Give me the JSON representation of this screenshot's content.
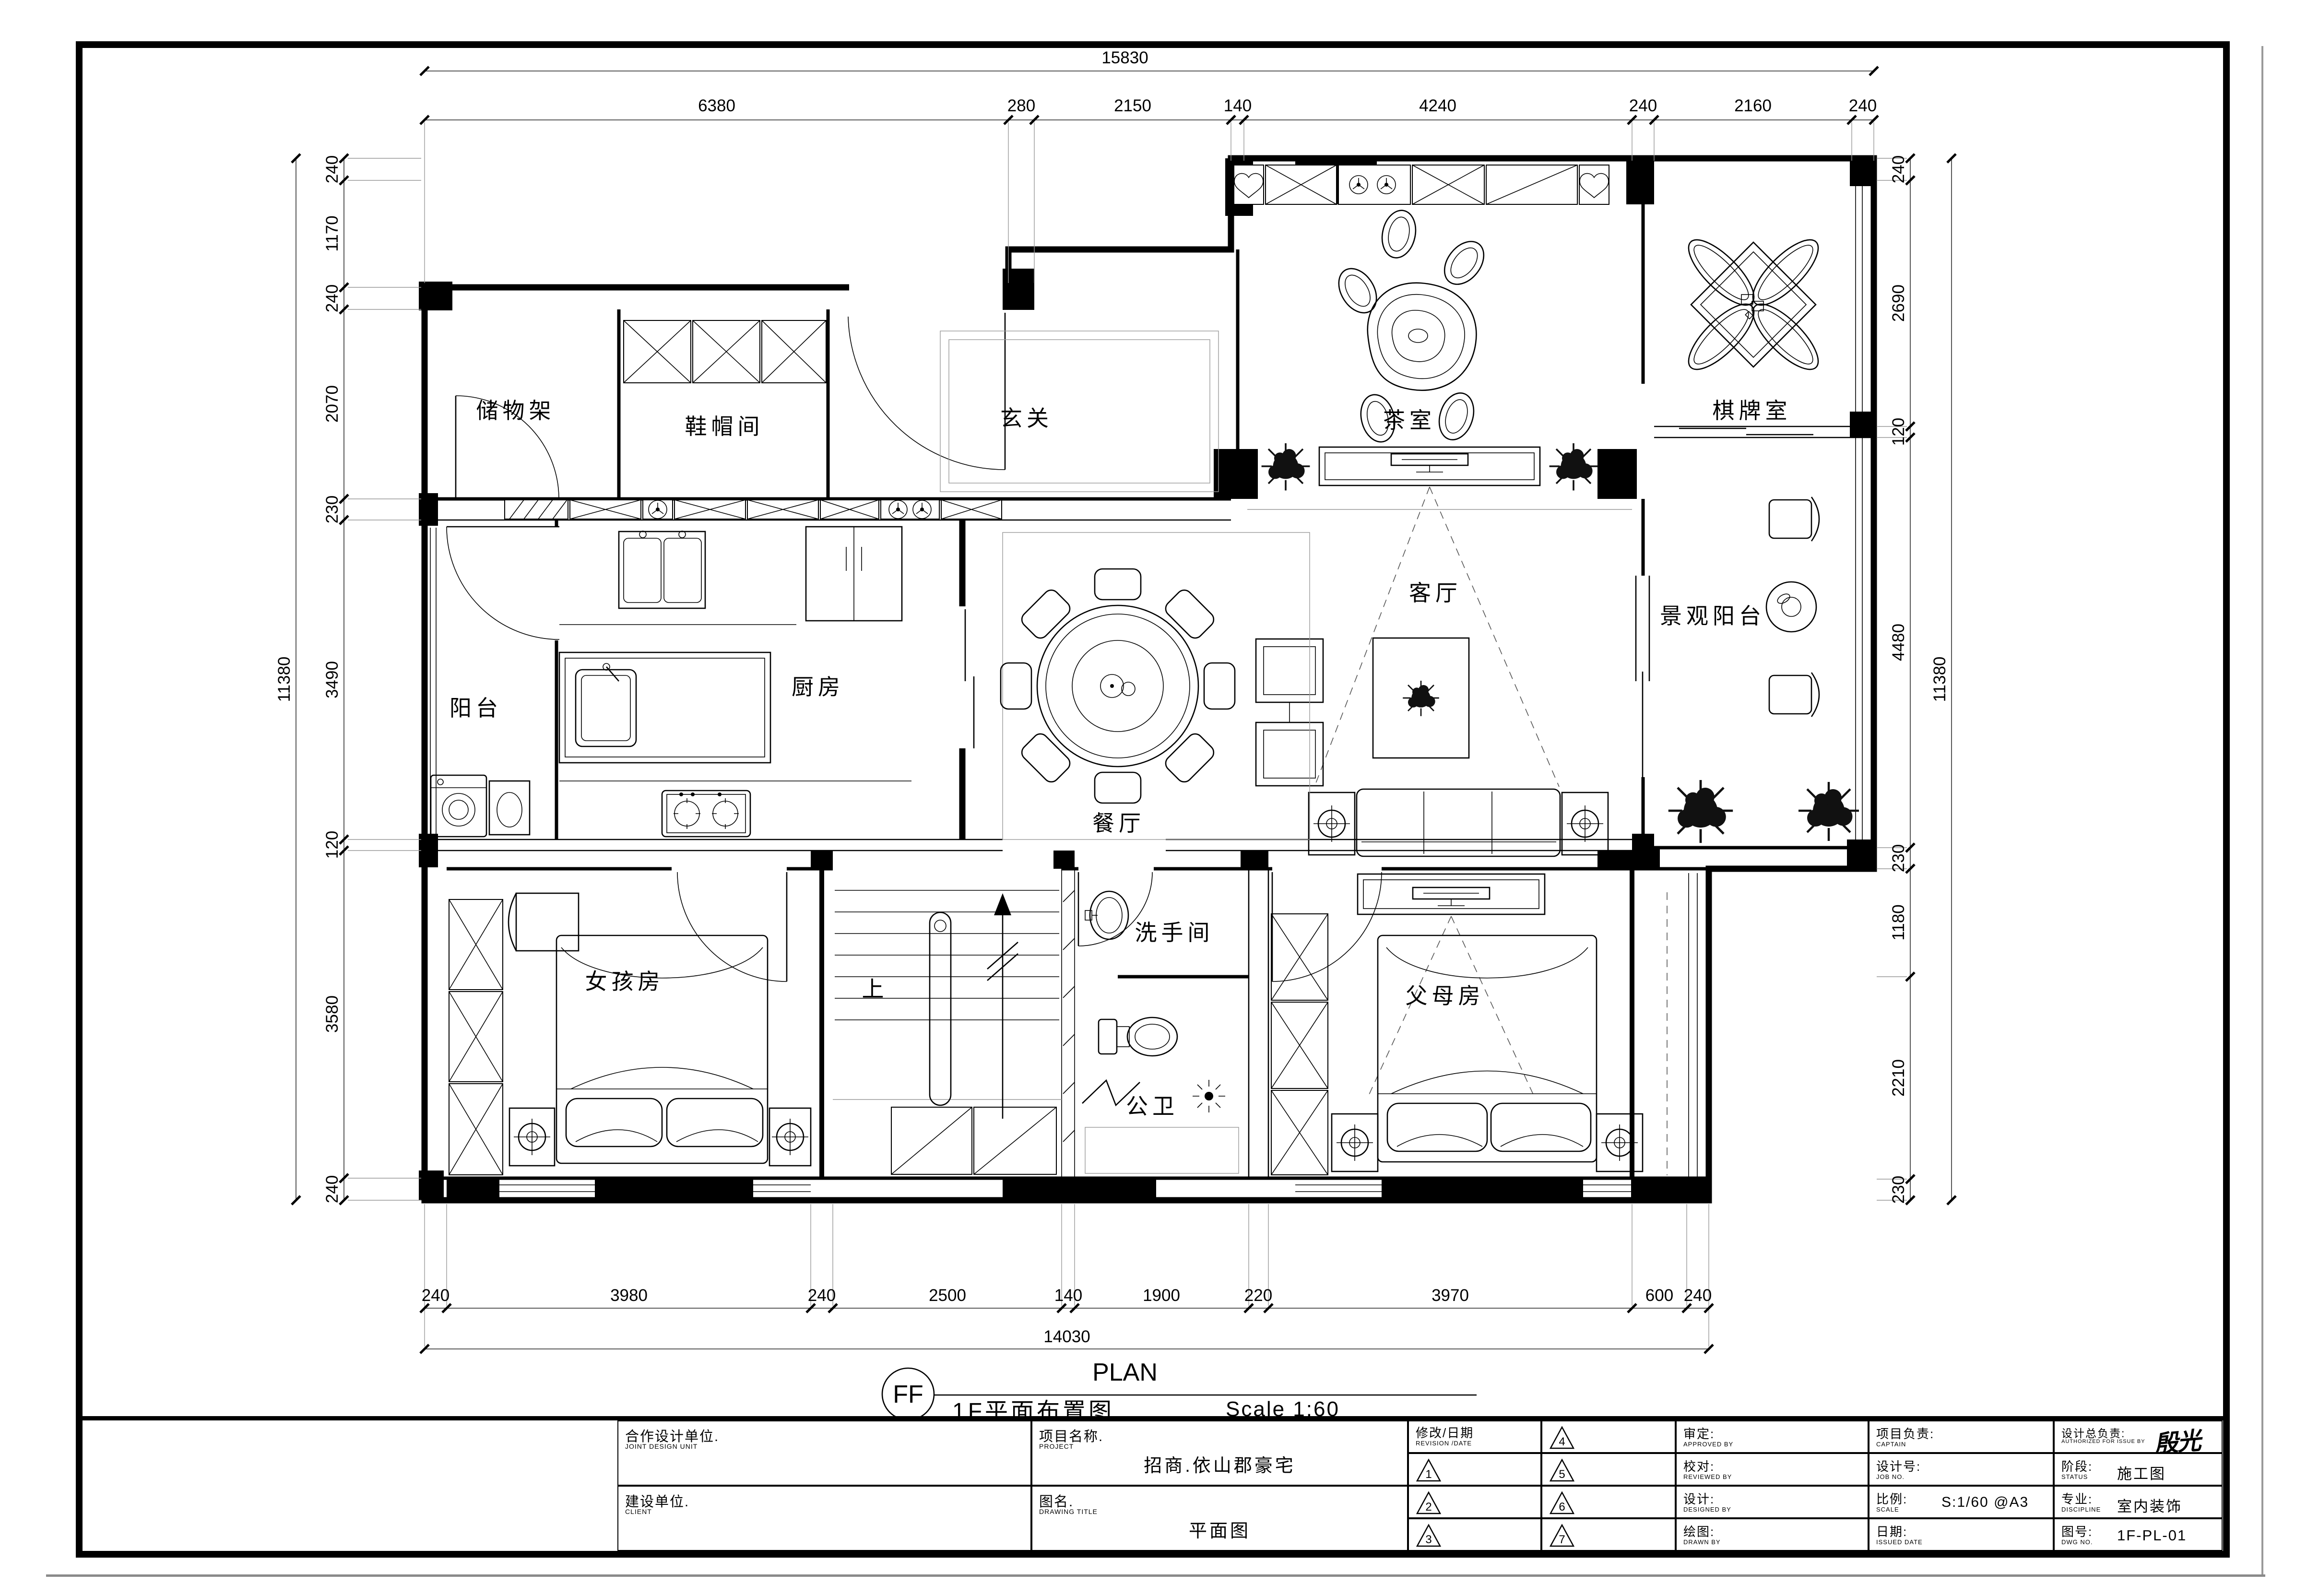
{
  "plan_header": {
    "ref": "FF",
    "title_zh": "1F平面布置图",
    "title_en": "PLAN",
    "scale_note": "Scale 1:60"
  },
  "rooms": {
    "storage": "储物架",
    "cloak": "鞋帽间",
    "foyer": "玄关",
    "tea": "茶室",
    "chess": "棋牌室",
    "balcony": "阳台",
    "kitchen": "厨房",
    "dining": "餐厅",
    "living": "客厅",
    "view_balcony": "景观阳台",
    "girl": "女孩房",
    "up": "上",
    "washroom": "洗手间",
    "bath": "公卫",
    "parents": "父母房"
  },
  "dims": {
    "top": {
      "total": "15830",
      "segments": [
        "6380",
        "280",
        "2150",
        "140",
        "4240",
        "240",
        "2160",
        "240"
      ]
    },
    "bottom": {
      "total": "14030",
      "segments": [
        "240",
        "3980",
        "240",
        "2500",
        "140",
        "1900",
        "220",
        "3970",
        "600",
        "240"
      ]
    },
    "left": {
      "total": "11380",
      "segments": [
        "240",
        "1170",
        "240",
        "2070",
        "230",
        "3490",
        "120",
        "3580",
        "240"
      ]
    },
    "right": {
      "total": "11380",
      "segments": [
        "240",
        "2690",
        "120",
        "4480",
        "230",
        "1180",
        "2210",
        "230"
      ]
    }
  },
  "titleblock": {
    "joint_zh": "合作设计单位.",
    "joint_en": "JOINT DESIGN UNIT",
    "client_zh": "建设单位.",
    "client_en": "CLIENT",
    "project_zh": "项目名称.",
    "project_en": "PROJECT",
    "project_value": "招商.依山郡豪宅",
    "dwgtitle_zh": "图名.",
    "dwgtitle_en": "DRAWING TITLE",
    "dwgtitle_value": "平面图",
    "revision_zh": "修改/日期",
    "revision_en": "REVISION /DATE",
    "revision_marks": [
      "1",
      "2",
      "3",
      "4",
      "5",
      "6",
      "7"
    ],
    "approved_zh": "审定:",
    "approved_en": "APPROVED BY",
    "reviewed_zh": "校对:",
    "reviewed_en": "REVIEWED BY",
    "designed_zh": "设计:",
    "designed_en": "DESIGNED BY",
    "drawn_zh": "绘图:",
    "drawn_en": "DRAWN BY",
    "captain_zh": "项目负责:",
    "captain_en": "CAPTAIN",
    "jobno_zh": "设计号:",
    "jobno_en": "JOB NO.",
    "scale_zh": "比例:",
    "scale_en": "SCALE",
    "scale_value": "S:1/60 @A3",
    "date_zh": "日期:",
    "date_en": "ISSUED DATE",
    "auth_zh": "设计总负责:",
    "auth_en": "AUTHORIZED FOR ISSUE BY",
    "auth_signature": "殷光林",
    "status_zh": "阶段:",
    "status_en": "STATUS",
    "status_value": "施工图",
    "disc_zh": "专业:",
    "disc_en": "DISCIPLINE",
    "disc_value": "室内装饰",
    "dwgno_zh": "图号:",
    "dwgno_en": "DWG NO.",
    "dwgno_value": "1F-PL-01"
  }
}
